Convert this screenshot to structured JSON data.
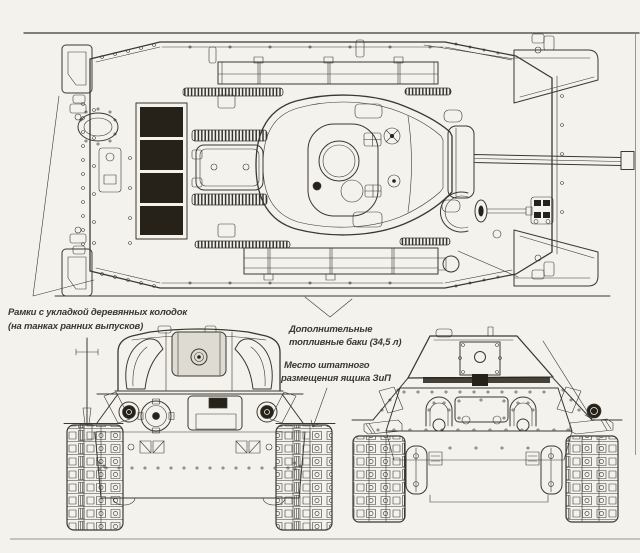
{
  "colors": {
    "paper": "#f4f2ed",
    "ink": "#3b3831",
    "dark": "#262219",
    "soft": "#9a968c",
    "plate": "#dedbd3"
  },
  "annotations": {
    "frames": {
      "line1": "Рамки с укладкой деревянных колодок",
      "line2": "(на танках ранних выпусков)"
    },
    "fuel_tanks": {
      "line1": "Дополнительные",
      "line2": "топливные баки (34,5 л)"
    },
    "zip_box": {
      "line1": "Место штатного",
      "line2": "размещения ящика ЗиП"
    }
  }
}
